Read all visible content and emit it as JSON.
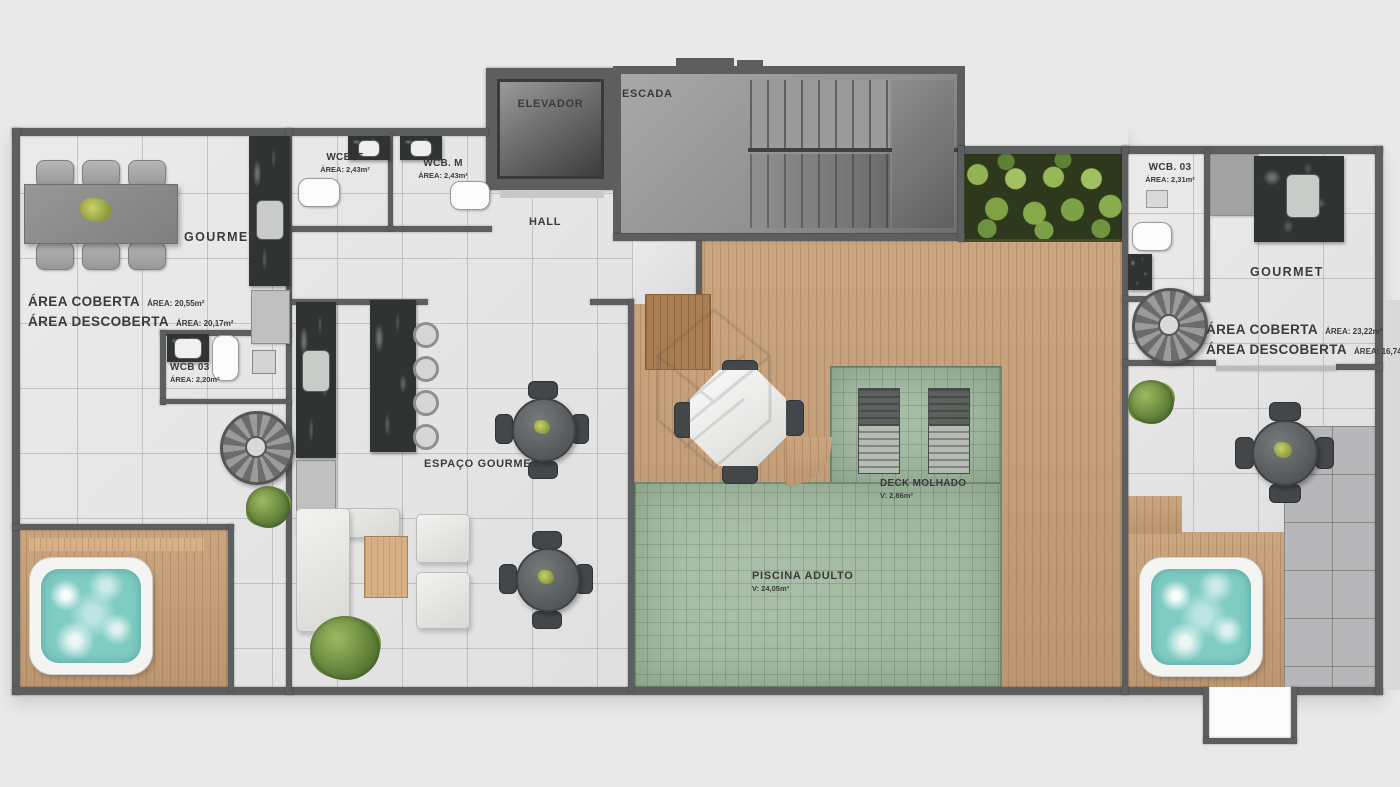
{
  "palette": {
    "bg": "#e9e9e9",
    "wall": "#5d5e5f",
    "tile": "#e4e4e5",
    "tile_dark": "#b7b7b9",
    "wood": "#c7a078",
    "wood_dark": "#a87e52",
    "pool": "#a2b9a1",
    "water": "#7fccc3",
    "marble": "#2f3331",
    "label": "#3b3b3b"
  },
  "rooms": {
    "elevador": {
      "label": "ELEVADOR"
    },
    "escada": {
      "label": "ESCADA"
    },
    "hall": {
      "label": "HALL"
    },
    "wcb_f": {
      "label": "WCB. F",
      "area": "ÁREA: 2,43m²"
    },
    "wcb_m": {
      "label": "WCB. M",
      "area": "ÁREA: 2,43m²"
    },
    "gourmet_left": {
      "label": "GOURMET"
    },
    "areas_left": {
      "coberta_label": "ÁREA COBERTA",
      "coberta_value": "ÁREA: 20,55m²",
      "descoberta_label": "ÁREA DESCOBERTA",
      "descoberta_value": "ÁREA: 20,17m²"
    },
    "wcb03_left": {
      "label": "WCB 03",
      "area": "ÁREA: 2,20m²"
    },
    "espaco_gourmet": {
      "label": "ESPAÇO GOURMET"
    },
    "deck_molhado": {
      "label": "DECK MOLHADO",
      "volume": "V: 2,86m³"
    },
    "piscina_adulto": {
      "label": "PISCINA ADULTO",
      "volume": "V: 24,05m³"
    },
    "wcb03_right": {
      "label": "WCB. 03",
      "area": "ÁREA: 2,31m²"
    },
    "gourmet_right": {
      "label": "GOURMET"
    },
    "areas_right": {
      "coberta_label": "ÁREA COBERTA",
      "coberta_value": "ÁREA: 23,22m²",
      "descoberta_label": "ÁREA DESCOBERTA",
      "descoberta_value": "ÁREA: 16,74m²"
    }
  }
}
